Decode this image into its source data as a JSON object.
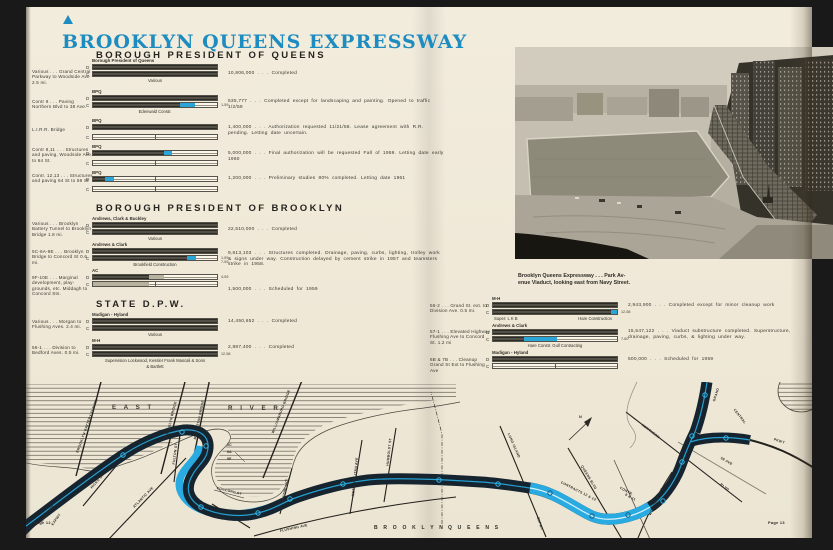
{
  "title": "BROOKLYN QUEENS EXPRESSWAY",
  "letters": {
    "d": "D",
    "c": "C"
  },
  "colors": {
    "accent_blue": "#1d8cc0",
    "bar_cyan": "#2aa5d8",
    "band_dark": "#15242e",
    "map_cyan": "#29abe2"
  },
  "footer": {
    "page_left": "Page 12",
    "page_right": "Page 13"
  },
  "photo": {
    "caption_line1": "Brooklyn Queens Expressway . . . Park Av-",
    "caption_line2": "enue Viaduct, looking east from Navy Street."
  },
  "queens": {
    "heading": "BOROUGH PRESIDENT OF QUEENS",
    "rows": [
      {
        "label": "Various . . . Grand Central Parkway to Woodside Ave 2.5 mi.",
        "firm": "Borough President of Queens",
        "sub": "Various",
        "d": {
          "dark": 100
        },
        "c": {
          "dark": 100
        },
        "note": "10,806,000 . . . Completed"
      },
      {
        "label": "Contr 9 . . . Paving Northern Blvd to 38 Ave.",
        "firm": "BPQ",
        "sub": "Edenwald Constr.",
        "d": {
          "dark": 100
        },
        "c": {
          "dark": 70,
          "cyan": 12,
          "tag": "1-59"
        },
        "note": "535,777 . . . Completed except for landscaping and painting. Opened to traffic 1/2/59"
      },
      {
        "label": "L.I.R.R. Bridge",
        "firm": "BPQ",
        "d": {
          "dark": 100
        },
        "c": {},
        "note": "1,400,000 . . . Authorization requested 11/21/58. Lease agreement with R.R. pending. Letting date uncertain."
      },
      {
        "label": "Contr 8,11 . . . Structures and paving, Woodside Ave. to 64 St.",
        "firm": "BPQ",
        "d": {
          "dark": 57,
          "cyan": 7
        },
        "c": {},
        "note": "5,000,000 . . . Final authorization will be requested Fall of 1959. Letting date early 1960"
      },
      {
        "label": "Contr. 12,13 . . . Structures and paving 64 St to 59 St",
        "firm": "BPQ",
        "d": {
          "dark": 10,
          "cyan": 7
        },
        "c": {},
        "note": "1,200,000 . . . Preliminary studies 80% completed. Letting date 1961"
      }
    ]
  },
  "brooklyn": {
    "heading": "BOROUGH PRESIDENT OF BROOKLYN",
    "rows": [
      {
        "label": "Various . . . Brooklyn Battery Tunnel to Brooklyn Bridge 1.8 mi.",
        "firm": "Andrews, Clark & Buckley",
        "sub": "Various",
        "d": {
          "dark": 100
        },
        "c": {
          "dark": 100
        },
        "note": "22,510,000 . . . Completed"
      },
      {
        "label": "5C-6A-9E . . . Brooklyn Bridge to Concord St 0.6 mi.",
        "firm": "Andrews & Clark",
        "sub": "Brookfield Construction",
        "d": {
          "dark": 100
        },
        "c": {
          "dark": 76,
          "cyan": 7,
          "tag": "1-59",
          "tag2": "7-59"
        },
        "note": "9,613,103 . . . Structures completed. Drainage, paving, curbs, lighting, trolley work & signs under way. Construction delayed by cement strike in 1957 and teamsters strike in 1958."
      },
      {
        "label": "9F-10E . . . Marginal development, play- grounds, etc. Middagh to Concord Sts.",
        "firm": "AC",
        "d": {
          "dark": 45,
          "gray": 12,
          "tag": "4-59"
        },
        "c": {
          "gray": 45
        },
        "note": "1,500,000 . . . Scheduled for 1959"
      }
    ]
  },
  "state": {
    "heading": "STATE D.P.W.",
    "rows": [
      {
        "label": "Various . . . Morgan to Flushing Aves. 2.4 mi.",
        "firm": "Madigan - Hyland",
        "sub": "Various",
        "d": {
          "dark": 100
        },
        "c": {
          "dark": 100
        },
        "note": "14,450,652 . . . Completed"
      },
      {
        "label": "56-1 . . . Division to Bedford Aves. 0.5 mi.",
        "firm": "M-H",
        "sub": "Supervision Lockwood, Kessler    Frank Mascali & Sons",
        "sub2": "& Bartlett",
        "d": {
          "dark": 100
        },
        "c": {
          "dark": 100,
          "tag": "12-58"
        },
        "note": "2,887,400 . . . Completed"
      }
    ]
  },
  "state_right": {
    "rows": [
      {
        "label": "56-2 . . . Grand St. ext. to Division Ave. 0.5 mi.",
        "firm": "M-H",
        "sub_left": "Super: L K B",
        "sub_right": "Hare Construction",
        "d": {
          "dark": 100
        },
        "c": {
          "dark": 95,
          "cyan": 5,
          "tag": "12-58"
        },
        "note": "2,943,900 . . . Completed except for minor cleanup work"
      },
      {
        "label": "57-1 . . . Elevated Highway Flushing Ave to Concord St. 1.2 mi",
        "firm": "Andrews & Clark",
        "sub": "Hare Constr.   Gull Contracting",
        "d": {
          "dark": 100
        },
        "c": {
          "dark": 25,
          "cyan": 27,
          "tag": "7-60"
        },
        "note": "15,547,122 . . . Viaduct substructure completed. Superstructure, drainage, paving, curbs, & lighting under way."
      },
      {
        "label": "6B & 7B . . . Cleanup Grand St Ext to Flushing Ave",
        "firm": "Madigan - Hyland",
        "d": {
          "dark": 100
        },
        "c": {},
        "note": "500,000 . . . Scheduled for 1959"
      }
    ]
  },
  "map": {
    "east": "E A S T",
    "river": "R I V E R",
    "battery": "BROOKLYN-BATTERY TUNNEL",
    "bbridge": "BROOKLYN BRIDGE",
    "mbridge": "MANHATTAN BRIDGE",
    "wbridge": "WILLIAMSBURG BRIDGE",
    "gowanus1": "GOWANUS",
    "gowanus2": "EXPWY",
    "hicks": "HICKS ST",
    "atlantic": "ATLANTIC AVE",
    "fulton": "FULTON ST",
    "concord": "CONCORD ST",
    "sec5c": "5C",
    "sec6a": "6A",
    "sec9e": "9E",
    "sec571": "57-1",
    "flushing": "FLUSHING AVE",
    "wythe": "WYTHE AVE",
    "metropolitan": "METROPOLITAN AVE",
    "humboldt": "HUMBOLDT ST",
    "lie1": "LONG ISLAND",
    "lie2": "EXPWY",
    "qblvd": "QUEENS BLVD",
    "contracts": "CONTRACTS 12 & 13",
    "contr811a": "CONTR.",
    "contr811b": "8 & 11",
    "northern": "NORTHERN",
    "nblvd": "BLVD",
    "ave58": "58 AVE",
    "woodside": "WOODSIDE AVE",
    "grand": "GRAND",
    "central": "CENTRAL",
    "pkwy": "PKWY",
    "bklyn": "B R O O K L Y N",
    "qns": "Q U E E N S",
    "north": "N"
  }
}
